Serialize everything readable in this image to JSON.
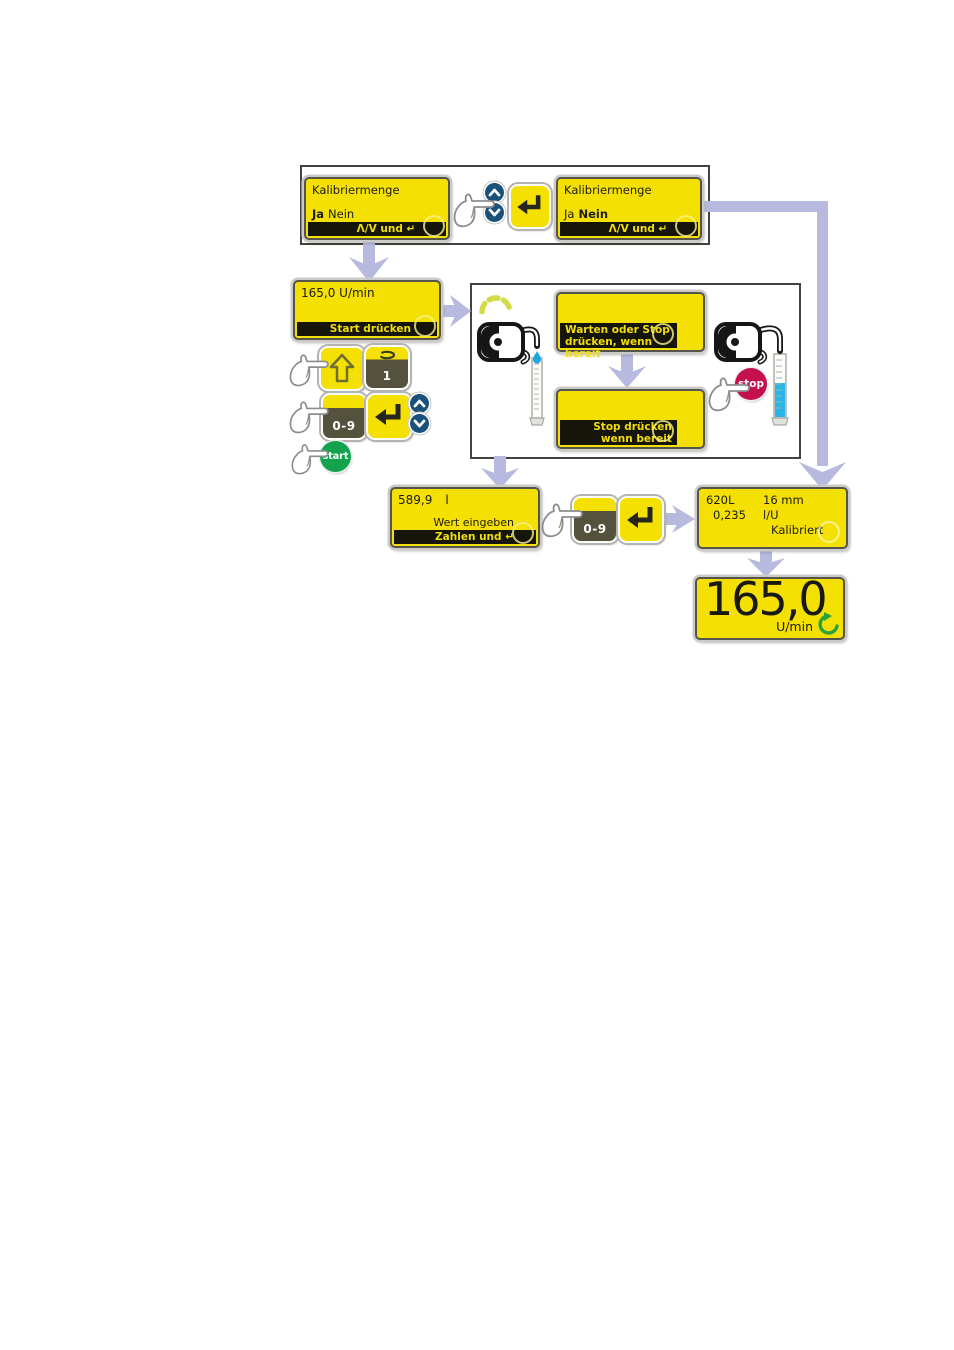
{
  "flow": {
    "screen_kal_left": {
      "title": "Kalibriermenge",
      "opt1": "Ja",
      "opt2": "Nein",
      "bar": "Λ/V und ↵"
    },
    "screen_kal_right": {
      "title": "Kalibriermenge",
      "opt1": "Ja",
      "opt2": "Nein",
      "bar": "Λ/V und ↵"
    },
    "screen_speed": {
      "value": "165,0 U/min",
      "bar": "Start drücken"
    },
    "screen_warten": {
      "bar_line1": "Warten oder Stop",
      "bar_line2": "drücken, wenn bereit"
    },
    "screen_stop": {
      "bar_line1": "Stop drücken",
      "bar_line2": "wenn bereit"
    },
    "screen_value": {
      "value": "589,9",
      "unit": "l",
      "hint": "Wert eingeben",
      "bar": "Zahlen und ↵"
    },
    "screen_result": {
      "r1c1": "620L",
      "r1c2": "16 mm",
      "r2c1": "0,235",
      "r2c2": "l/U",
      "r3": "Kalibriert"
    },
    "screen_final": {
      "value": "165,0",
      "unit": "U/min"
    }
  },
  "keys": {
    "one": "1",
    "digits": "0-9",
    "start": "start",
    "stop": "stop"
  },
  "colors": {
    "display_yellow": "#f5e003",
    "bar_black": "#15150c",
    "bar_text_yellow": "#f2de08",
    "arrow_lavender": "#b7bade",
    "button_blue": "#1a517b",
    "start_green": "#13a24d",
    "stop_red": "#c4114d",
    "key_dark_olive": "#54523c",
    "liquid_blue": "#27b4e8",
    "speed_arc_yellow_green": "#d5da49",
    "rotation_green": "#2aa33c"
  }
}
